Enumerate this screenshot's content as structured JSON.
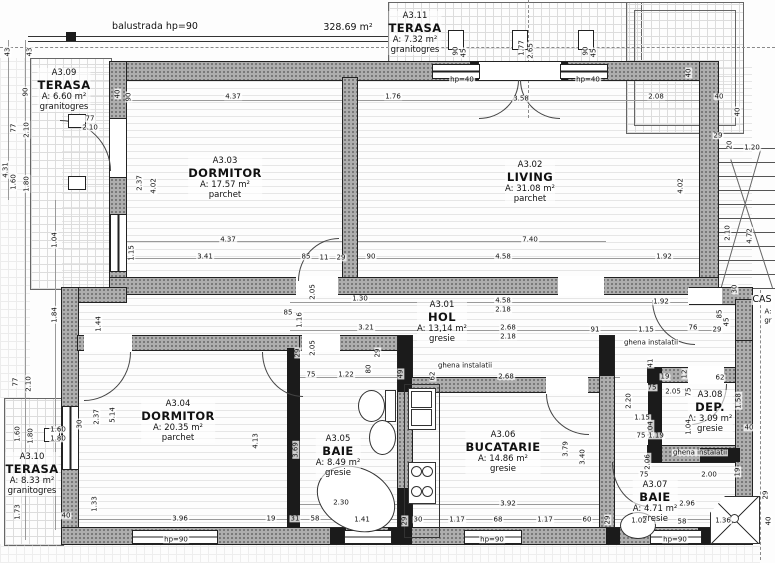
{
  "plan_title": "floor plan apartment A3",
  "annotations": {
    "balustrade": "balustrada hp=90",
    "total_area": "328.69 m²",
    "shaft": "ghena instalatii",
    "stairwell_partial": "CAS"
  },
  "rooms": [
    {
      "id": "A3.01",
      "name": "HOL",
      "area": "A: 13,14 m²",
      "floor": "gresie"
    },
    {
      "id": "A3.02",
      "name": "LIVING",
      "area": "A: 31.08 m²",
      "floor": "parchet"
    },
    {
      "id": "A3.03",
      "name": "DORMITOR",
      "area": "A: 17.57 m²",
      "floor": "parchet"
    },
    {
      "id": "A3.04",
      "name": "DORMITOR",
      "area": "A: 20.35 m²",
      "floor": "parchet"
    },
    {
      "id": "A3.05",
      "name": "BAIE",
      "area": "A: 8.49 m²",
      "floor": "gresie"
    },
    {
      "id": "A3.06",
      "name": "BUCATARIE",
      "area": "A: 14.86 m²",
      "floor": "gresie"
    },
    {
      "id": "A3.07",
      "name": "BAIE",
      "area": "A: 4.71 m²",
      "floor": "gresie"
    },
    {
      "id": "A3.08",
      "name": "DEP.",
      "area": "A: 3.09 m²",
      "floor": "gresie"
    },
    {
      "id": "A3.09",
      "name": "TERASA",
      "area": "A: 6.60 m²",
      "floor": "granitogres"
    },
    {
      "id": "A3.10",
      "name": "TERASA",
      "area": "A: 8.33 m²",
      "floor": "granitogres"
    },
    {
      "id": "A3.11",
      "name": "TERASA",
      "area": "A: 7.32 m²",
      "floor": "granitogres"
    }
  ],
  "dim_labels": [
    {
      "t": "balustrada hp=90",
      "x": 155,
      "y": 27,
      "b": 1
    },
    {
      "t": "328.69 m²",
      "x": 348,
      "y": 28,
      "b": 1
    },
    {
      "t": "43",
      "x": 8,
      "y": 52,
      "r": 1
    },
    {
      "t": "43",
      "x": 30,
      "y": 52,
      "r": 1
    },
    {
      "t": "90",
      "x": 26,
      "y": 92,
      "r": 1
    },
    {
      "t": "77",
      "x": 14,
      "y": 128,
      "r": 1
    },
    {
      "t": "2.10",
      "x": 27,
      "y": 130,
      "r": 1
    },
    {
      "t": "4.31",
      "x": 6,
      "y": 170,
      "r": 1
    },
    {
      "t": "1.60",
      "x": 14,
      "y": 182,
      "r": 1
    },
    {
      "t": "1.80",
      "x": 27,
      "y": 184,
      "r": 1
    },
    {
      "t": "1.04",
      "x": 55,
      "y": 240,
      "r": 1
    },
    {
      "t": "1.84",
      "x": 55,
      "y": 315,
      "r": 1
    },
    {
      "t": "77",
      "x": 16,
      "y": 382,
      "r": 1
    },
    {
      "t": "2.10",
      "x": 29,
      "y": 384,
      "r": 1
    },
    {
      "t": "1.60",
      "x": 18,
      "y": 434,
      "r": 1
    },
    {
      "t": "1.80",
      "x": 31,
      "y": 436,
      "r": 1
    },
    {
      "t": "1.73",
      "x": 18,
      "y": 512,
      "r": 1
    },
    {
      "t": "77",
      "x": 90,
      "y": 119
    },
    {
      "t": "2.10",
      "x": 90,
      "y": 128
    },
    {
      "t": "1.60",
      "x": 58,
      "y": 430
    },
    {
      "t": "1.80",
      "x": 58,
      "y": 439
    },
    {
      "t": "1.44",
      "x": 99,
      "y": 324,
      "r": 1
    },
    {
      "t": "1.33",
      "x": 95,
      "y": 504,
      "r": 1
    },
    {
      "t": "40",
      "x": 66,
      "y": 516
    },
    {
      "t": "2.37",
      "x": 97,
      "y": 417,
      "r": 1
    },
    {
      "t": "5.14",
      "x": 113,
      "y": 415,
      "r": 1
    },
    {
      "t": "30",
      "x": 80,
      "y": 424,
      "r": 1
    },
    {
      "t": "40",
      "x": 118,
      "y": 94,
      "r": 1
    },
    {
      "t": "90",
      "x": 129,
      "y": 97,
      "r": 1
    },
    {
      "t": "4.37",
      "x": 233,
      "y": 97
    },
    {
      "t": "1.76",
      "x": 393,
      "y": 97
    },
    {
      "t": "3.58",
      "x": 521,
      "y": 99
    },
    {
      "t": "2.08",
      "x": 656,
      "y": 97
    },
    {
      "t": "90",
      "x": 456,
      "y": 51,
      "r": 1
    },
    {
      "t": "45",
      "x": 464,
      "y": 53,
      "r": 1
    },
    {
      "t": "1.77",
      "x": 522,
      "y": 48,
      "r": 1
    },
    {
      "t": "2.65",
      "x": 531,
      "y": 51,
      "r": 1
    },
    {
      "t": "90",
      "x": 586,
      "y": 51,
      "r": 1
    },
    {
      "t": "45",
      "x": 594,
      "y": 53,
      "r": 1
    },
    {
      "t": "hp=40",
      "x": 462,
      "y": 80
    },
    {
      "t": "hp=40",
      "x": 588,
      "y": 80
    },
    {
      "t": "2.37",
      "x": 140,
      "y": 183,
      "r": 1
    },
    {
      "t": "4.02",
      "x": 154,
      "y": 186,
      "r": 1
    },
    {
      "t": "1.15",
      "x": 132,
      "y": 253,
      "r": 1
    },
    {
      "t": "4.37",
      "x": 228,
      "y": 240
    },
    {
      "t": "3.41",
      "x": 205,
      "y": 257
    },
    {
      "t": "85",
      "x": 306,
      "y": 257
    },
    {
      "t": "11",
      "x": 324,
      "y": 258
    },
    {
      "t": "29",
      "x": 341,
      "y": 258
    },
    {
      "t": "90",
      "x": 371,
      "y": 257
    },
    {
      "t": "7.40",
      "x": 530,
      "y": 240
    },
    {
      "t": "4.58",
      "x": 503,
      "y": 257
    },
    {
      "t": "1.92",
      "x": 664,
      "y": 257
    },
    {
      "t": "4.02",
      "x": 681,
      "y": 186,
      "r": 1
    },
    {
      "t": "40",
      "x": 689,
      "y": 73,
      "r": 1
    },
    {
      "t": "40",
      "x": 719,
      "y": 97
    },
    {
      "t": "40",
      "x": 738,
      "y": 112,
      "r": 1
    },
    {
      "t": "29",
      "x": 718,
      "y": 136
    },
    {
      "t": "20",
      "x": 730,
      "y": 145,
      "r": 1
    },
    {
      "t": "1.20",
      "x": 752,
      "y": 148
    },
    {
      "t": "2.10",
      "x": 728,
      "y": 233,
      "r": 1
    },
    {
      "t": "4.72",
      "x": 750,
      "y": 236,
      "r": 1
    },
    {
      "t": "30",
      "x": 735,
      "y": 289,
      "r": 1
    },
    {
      "t": "1.30",
      "x": 360,
      "y": 299
    },
    {
      "t": "4.58",
      "x": 503,
      "y": 301
    },
    {
      "t": "2.18",
      "x": 503,
      "y": 310
    },
    {
      "t": "1.92",
      "x": 661,
      "y": 302
    },
    {
      "t": "3.21",
      "x": 366,
      "y": 328
    },
    {
      "t": "2.68",
      "x": 508,
      "y": 328
    },
    {
      "t": "2.18",
      "x": 508,
      "y": 337
    },
    {
      "t": "91",
      "x": 595,
      "y": 330
    },
    {
      "t": "1.15",
      "x": 646,
      "y": 330
    },
    {
      "t": "76",
      "x": 693,
      "y": 328
    },
    {
      "t": "29",
      "x": 717,
      "y": 330
    },
    {
      "t": "85",
      "x": 720,
      "y": 314,
      "r": 1
    },
    {
      "t": "45",
      "x": 727,
      "y": 322,
      "r": 1
    },
    {
      "t": "85",
      "x": 288,
      "y": 313
    },
    {
      "t": "1.16",
      "x": 300,
      "y": 320,
      "r": 1
    },
    {
      "t": "2.05",
      "x": 313,
      "y": 292,
      "r": 1
    },
    {
      "t": "29",
      "x": 298,
      "y": 353,
      "r": 1
    },
    {
      "t": "2.05",
      "x": 313,
      "y": 348,
      "r": 1
    },
    {
      "t": "75",
      "x": 311,
      "y": 375
    },
    {
      "t": "1.22",
      "x": 346,
      "y": 375
    },
    {
      "t": "80",
      "x": 369,
      "y": 369,
      "r": 1
    },
    {
      "t": "29",
      "x": 378,
      "y": 353,
      "r": 1
    },
    {
      "t": "49",
      "x": 401,
      "y": 374,
      "r": 1
    },
    {
      "t": "62",
      "x": 433,
      "y": 376,
      "r": 1
    },
    {
      "t": "2.68",
      "x": 506,
      "y": 377
    },
    {
      "t": "ghena instalatii",
      "x": 465,
      "y": 366
    },
    {
      "t": "ghena instalatii",
      "x": 651,
      "y": 343
    },
    {
      "t": "ghena instalatii",
      "x": 700,
      "y": 453
    },
    {
      "t": "41",
      "x": 651,
      "y": 363,
      "r": 1
    },
    {
      "t": "19",
      "x": 665,
      "y": 377
    },
    {
      "t": "75",
      "x": 652,
      "y": 388
    },
    {
      "t": "2.05",
      "x": 673,
      "y": 392
    },
    {
      "t": "12",
      "x": 685,
      "y": 374,
      "r": 1
    },
    {
      "t": "62",
      "x": 720,
      "y": 378
    },
    {
      "t": "75",
      "x": 689,
      "y": 392,
      "r": 1
    },
    {
      "t": "2.20",
      "x": 629,
      "y": 401,
      "r": 1
    },
    {
      "t": "1.58",
      "x": 739,
      "y": 401,
      "r": 1
    },
    {
      "t": "1.15",
      "x": 642,
      "y": 418
    },
    {
      "t": "1.04",
      "x": 651,
      "y": 429,
      "r": 1
    },
    {
      "t": "75",
      "x": 641,
      "y": 436
    },
    {
      "t": "1.19",
      "x": 656,
      "y": 436
    },
    {
      "t": "1.04",
      "x": 689,
      "y": 427,
      "r": 1
    },
    {
      "t": "40",
      "x": 749,
      "y": 428
    },
    {
      "t": "2.06",
      "x": 648,
      "y": 462,
      "r": 1
    },
    {
      "t": "75",
      "x": 644,
      "y": 475
    },
    {
      "t": "2.00",
      "x": 709,
      "y": 475
    },
    {
      "t": "19",
      "x": 738,
      "y": 472,
      "r": 1
    },
    {
      "t": "3.69",
      "x": 296,
      "y": 450,
      "r": 1
    },
    {
      "t": "2.30",
      "x": 341,
      "y": 503
    },
    {
      "t": "31",
      "x": 295,
      "y": 519
    },
    {
      "t": "58",
      "x": 315,
      "y": 519
    },
    {
      "t": "1.41",
      "x": 362,
      "y": 520
    },
    {
      "t": "29",
      "x": 405,
      "y": 521,
      "r": 1
    },
    {
      "t": "30",
      "x": 418,
      "y": 520
    },
    {
      "t": "3.79",
      "x": 566,
      "y": 449,
      "r": 1
    },
    {
      "t": "3.40",
      "x": 583,
      "y": 457,
      "r": 1
    },
    {
      "t": "3.92",
      "x": 508,
      "y": 504
    },
    {
      "t": "1.17",
      "x": 457,
      "y": 520
    },
    {
      "t": "68",
      "x": 498,
      "y": 520
    },
    {
      "t": "1.17",
      "x": 545,
      "y": 520
    },
    {
      "t": "60",
      "x": 587,
      "y": 520
    },
    {
      "t": "29",
      "x": 608,
      "y": 520,
      "r": 1
    },
    {
      "t": "4.13",
      "x": 256,
      "y": 441,
      "r": 1
    },
    {
      "t": "3.96",
      "x": 180,
      "y": 519
    },
    {
      "t": "19",
      "x": 271,
      "y": 519
    },
    {
      "t": "2.96",
      "x": 687,
      "y": 504
    },
    {
      "t": "1.02",
      "x": 639,
      "y": 521
    },
    {
      "t": "58",
      "x": 682,
      "y": 522
    },
    {
      "t": "1.36",
      "x": 723,
      "y": 521
    },
    {
      "t": "29",
      "x": 766,
      "y": 495,
      "r": 1
    },
    {
      "t": "40",
      "x": 769,
      "y": 521,
      "r": 1
    },
    {
      "t": "hp=90",
      "x": 176,
      "y": 540
    },
    {
      "t": "hp=90",
      "x": 492,
      "y": 540
    },
    {
      "t": "hp=90",
      "x": 675,
      "y": 540
    },
    {
      "t": "CAS",
      "x": 762,
      "y": 300,
      "b": 1
    },
    {
      "t": "A:",
      "x": 768,
      "y": 312
    },
    {
      "t": "gr",
      "x": 768,
      "y": 321
    }
  ],
  "colors": {
    "wall_gray": "#aeaeae",
    "wall_black": "#1b1b1b",
    "line": "#222222",
    "paper": "#fdfdfd"
  }
}
